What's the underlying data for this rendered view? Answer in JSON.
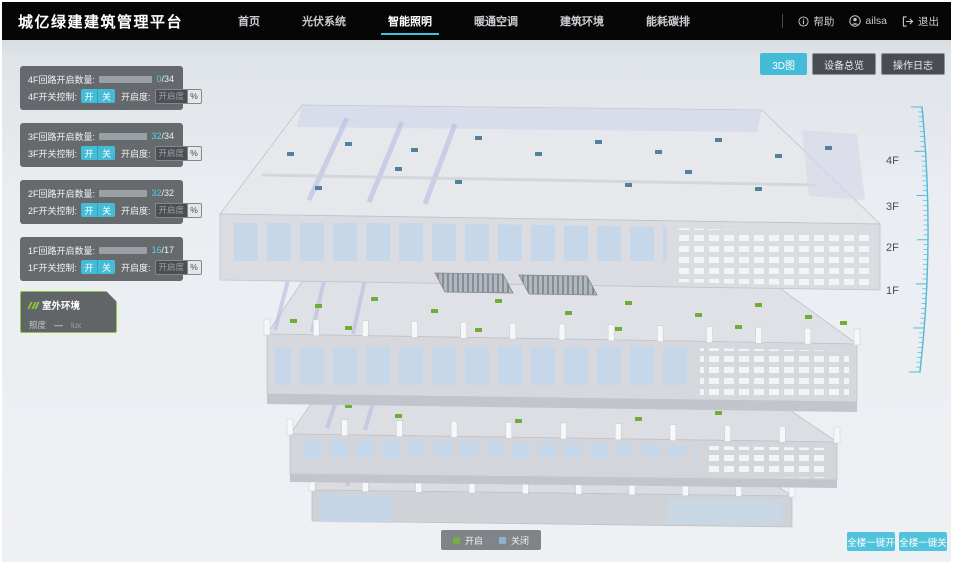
{
  "header": {
    "title": "城亿绿建建筑管理平台",
    "nav": [
      {
        "label": "首页"
      },
      {
        "label": "光伏系统"
      },
      {
        "label": "智能照明"
      },
      {
        "label": "暖通空调"
      },
      {
        "label": "建筑环境"
      },
      {
        "label": "能耗碳排"
      }
    ],
    "active_nav": "智能照明",
    "help_label": "帮助",
    "username": "ailsa",
    "logout_label": "退出"
  },
  "view_buttons": [
    {
      "label": "3D图",
      "active": true
    },
    {
      "label": "设备总览",
      "active": false
    },
    {
      "label": "操作日志",
      "active": false
    }
  ],
  "floor_panels": [
    {
      "count_label": "4F回路开启数量:",
      "count_value": "0",
      "count_total": "/34",
      "progress_pct": 0,
      "switch_label": "4F开关控制:",
      "on_label": "开",
      "off_label": "关",
      "dim_label": "开启度:",
      "dim_placeholder": "开启度",
      "percent_label": "%"
    },
    {
      "count_label": "3F回路开启数量:",
      "count_value": "32",
      "count_total": "/34",
      "progress_pct": 94,
      "switch_label": "3F开关控制:",
      "on_label": "开",
      "off_label": "关",
      "dim_label": "开启度:",
      "dim_placeholder": "开启度",
      "percent_label": "%"
    },
    {
      "count_label": "2F回路开启数量:",
      "count_value": "32",
      "count_total": "/32",
      "progress_pct": 100,
      "switch_label": "2F开关控制:",
      "on_label": "开",
      "off_label": "关",
      "dim_label": "开启度:",
      "dim_placeholder": "开启度",
      "percent_label": "%"
    },
    {
      "count_label": "1F回路开启数量:",
      "count_value": "16",
      "count_total": "/17",
      "progress_pct": 94,
      "switch_label": "1F开关控制:",
      "on_label": "开",
      "off_label": "关",
      "dim_label": "开启度:",
      "dim_placeholder": "开启度",
      "percent_label": "%"
    }
  ],
  "outdoor_panel": {
    "title": "室外环境",
    "illuminance_label": "照度",
    "illuminance_value": "—",
    "illuminance_unit": "lux"
  },
  "scene": {
    "floor_labels": [
      "4F",
      "3F",
      "2F",
      "1F"
    ],
    "legend": [
      {
        "label": "开启",
        "color": "#72b043"
      },
      {
        "label": "关闭",
        "color": "#8fb0cf"
      }
    ]
  },
  "bottom_buttons": [
    {
      "label": "全楼一键开"
    },
    {
      "label": "全楼一键关"
    }
  ],
  "colors": {
    "accent_cyan": "#45bcd7",
    "light_on_green": "#6fae35",
    "light_off_blue": "#54809f",
    "panel_gray": "#5c6064",
    "header_black": "#060606"
  }
}
